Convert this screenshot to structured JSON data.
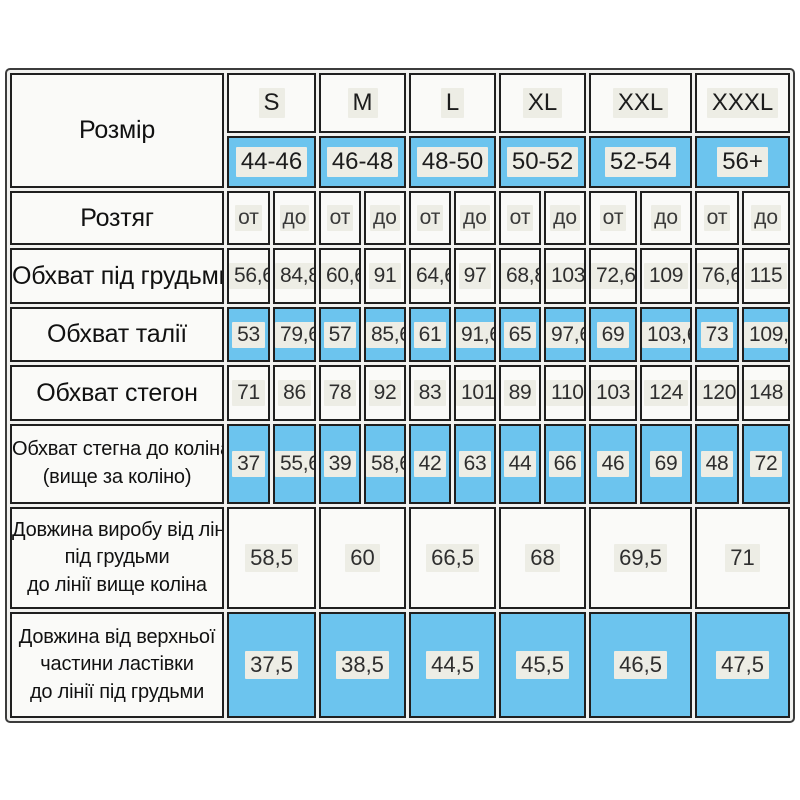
{
  "colors": {
    "blue": "#6cc4ee",
    "highlight": "#ededE5",
    "border": "#1f1f1f"
  },
  "table": {
    "header": {
      "size_label": "Розмір",
      "sizes": [
        "S",
        "M",
        "L",
        "XL",
        "XXL",
        "XXXL"
      ],
      "ranges": [
        "44-46",
        "46-48",
        "48-50",
        "50-52",
        "52-54",
        "56+"
      ]
    },
    "stretch": {
      "label": "Розтяг",
      "from": "от",
      "to": "до"
    },
    "rows": {
      "underbust": {
        "label": "Обхват під грудьми",
        "values": [
          [
            "56,6",
            "84,8"
          ],
          [
            "60,6",
            "91"
          ],
          [
            "64,6",
            "97"
          ],
          [
            "68,8",
            "103"
          ],
          [
            "72,6",
            "109"
          ],
          [
            "76,6",
            "115"
          ]
        ]
      },
      "waist": {
        "label": "Обхват талії",
        "values": [
          [
            "53",
            "79,6"
          ],
          [
            "57",
            "85,6"
          ],
          [
            "61",
            "91,6"
          ],
          [
            "65",
            "97,6"
          ],
          [
            "69",
            "103,6"
          ],
          [
            "73",
            "109,6"
          ]
        ]
      },
      "hips": {
        "label": "Обхват стегон",
        "values": [
          [
            "71",
            "86"
          ],
          [
            "78",
            "92"
          ],
          [
            "83",
            "101"
          ],
          [
            "89",
            "110"
          ],
          [
            "103",
            "124"
          ],
          [
            "120",
            "148"
          ]
        ]
      },
      "thigh": {
        "label_lines": [
          "Обхват стегна до коліна",
          "(вище за коліно)"
        ],
        "values": [
          [
            "37",
            "55,6"
          ],
          [
            "39",
            "58,6"
          ],
          [
            "42",
            "63"
          ],
          [
            "44",
            "66"
          ],
          [
            "46",
            "69"
          ],
          [
            "48",
            "72"
          ]
        ]
      },
      "product_length": {
        "label_lines": [
          "Довжина виробу від лінії",
          "під грудьми",
          "до лінії вище коліна"
        ],
        "values": [
          "58,5",
          "60",
          "66,5",
          "68",
          "69,5",
          "71"
        ]
      },
      "top_length": {
        "label_lines": [
          "Довжина від верхньої",
          "частини ластівки",
          "до лінії під грудьми"
        ],
        "values": [
          "37,5",
          "38,5",
          "44,5",
          "45,5",
          "46,5",
          "47,5"
        ]
      }
    }
  },
  "chart_data": {
    "type": "table",
    "title": "",
    "columns": [
      "Розмір",
      "S от",
      "S до",
      "M от",
      "M до",
      "L от",
      "L до",
      "XL от",
      "XL до",
      "XXL от",
      "XXL до",
      "XXXL от",
      "XXXL до"
    ],
    "rows": [
      [
        "Розмір (укр.)",
        "44-46",
        "44-46",
        "46-48",
        "46-48",
        "48-50",
        "48-50",
        "50-52",
        "50-52",
        "52-54",
        "52-54",
        "56+",
        "56+"
      ],
      [
        "Обхват під грудьми",
        "56,6",
        "84,8",
        "60,6",
        "91",
        "64,6",
        "97",
        "68,8",
        "103",
        "72,6",
        "109",
        "76,6",
        "115"
      ],
      [
        "Обхват талії",
        "53",
        "79,6",
        "57",
        "85,6",
        "61",
        "91,6",
        "65",
        "97,6",
        "69",
        "103,6",
        "73",
        "109,6"
      ],
      [
        "Обхват стегон",
        "71",
        "86",
        "78",
        "92",
        "83",
        "101",
        "89",
        "110",
        "103",
        "124",
        "120",
        "148"
      ],
      [
        "Обхват стегна до коліна (вище за коліно)",
        "37",
        "55,6",
        "39",
        "58,6",
        "42",
        "63",
        "44",
        "66",
        "46",
        "69",
        "48",
        "72"
      ],
      [
        "Довжина виробу від лінії під грудьми до лінії вище коліна",
        "58,5",
        "58,5",
        "60",
        "60",
        "66,5",
        "66,5",
        "68",
        "68",
        "69,5",
        "69,5",
        "71",
        "71"
      ],
      [
        "Довжина від верхньої частини ластівки до лінії під грудьми",
        "37,5",
        "37,5",
        "38,5",
        "38,5",
        "44,5",
        "44,5",
        "45,5",
        "45,5",
        "46,5",
        "46,5",
        "47,5",
        "47,5"
      ]
    ]
  }
}
